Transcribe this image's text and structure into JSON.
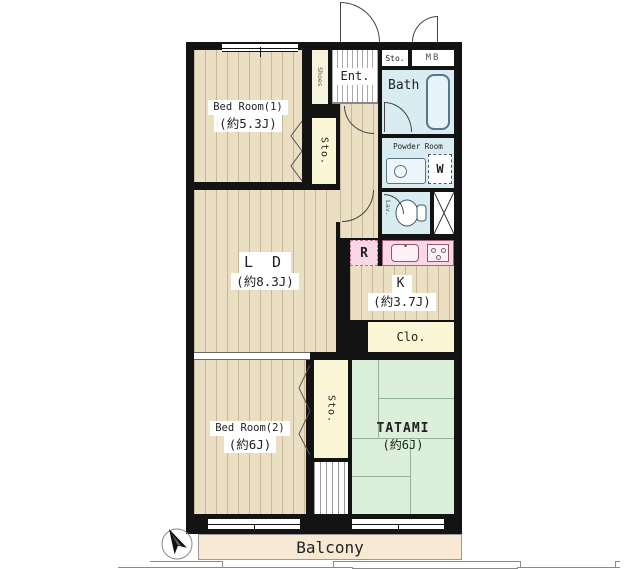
{
  "rooms": {
    "bedroom1": {
      "name": "Bed Room(1)",
      "area": "(約5.3J)"
    },
    "ld": {
      "name": "L D",
      "area": "(約8.3J)"
    },
    "kitchen": {
      "name": "K",
      "area": "(約3.7J)"
    },
    "bedroom2": {
      "name": "Bed Room(2)",
      "area": "(約6J)"
    },
    "tatami": {
      "name": "TATAMI",
      "area": "(約6J)"
    },
    "bath": {
      "name": "Bath"
    },
    "powder_room": {
      "name": "Powder Room"
    },
    "lavatory": {
      "name": "Lav."
    },
    "entrance": {
      "name": "Ent."
    },
    "shoes": {
      "name": "Shoes"
    },
    "storage_hall": {
      "name": "Sto."
    },
    "storage_top": {
      "name": "Sto."
    },
    "storage_bottom": {
      "name": "Sto."
    },
    "closet": {
      "name": "Clo."
    },
    "meter_box": {
      "name": "MB"
    },
    "balcony": {
      "name": "Balcony"
    }
  },
  "fixtures": {
    "refrigerator": {
      "label": "R"
    },
    "washing_machine": {
      "label": "W"
    }
  },
  "colors": {
    "wall": "#131313",
    "wood_floor": "#EBDFC3",
    "tatami": "#DCEFDA",
    "wet_area": "#D8ECF2",
    "kitchen_counter": "#F8D7E7",
    "storage": "#FBF7D6",
    "balcony": "#F8E9D5"
  }
}
